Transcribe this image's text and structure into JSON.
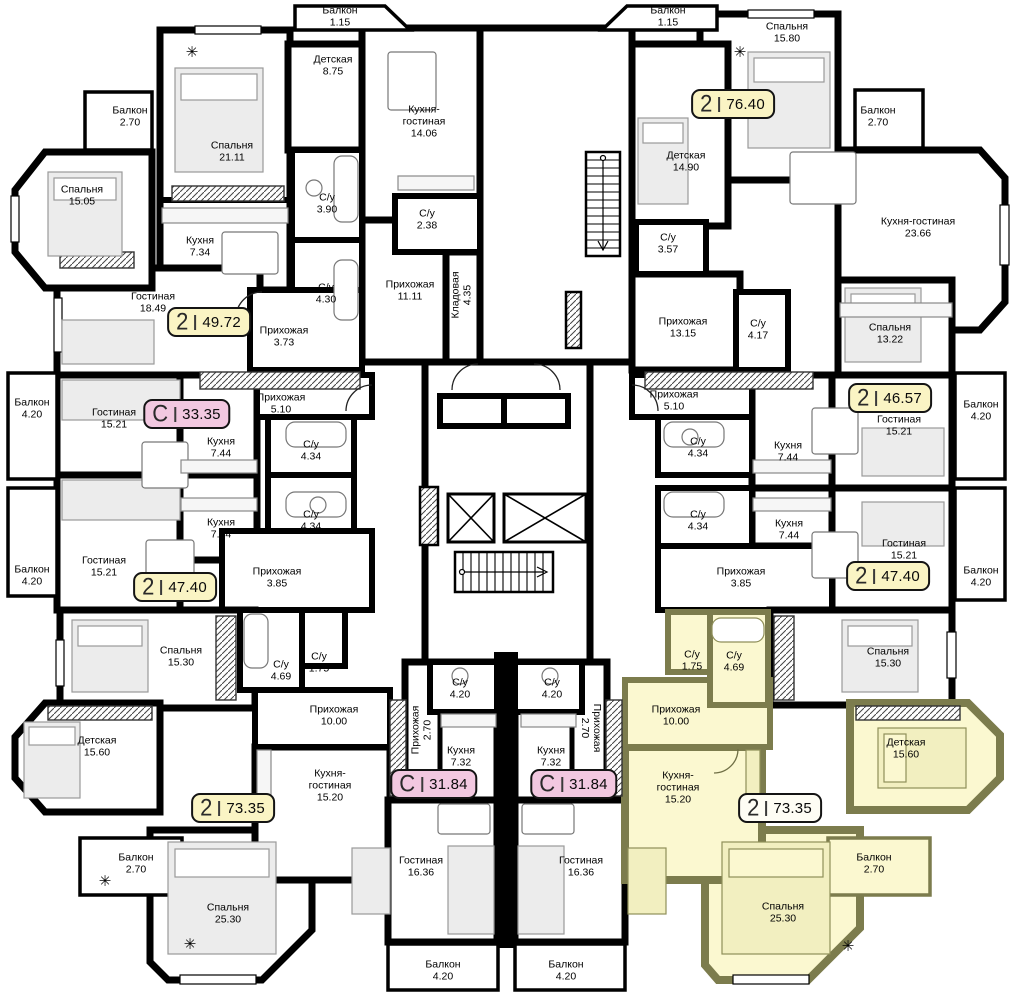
{
  "plan": {
    "badge_colors": {
      "yellow": "#FAF4C4",
      "pink": "#F2C8E0",
      "cream": "#FEFDF4"
    },
    "highlight": {
      "room_fill": "#FBF8D0",
      "wall_color": "#7C7C4D"
    },
    "walls_color": "#000000",
    "badges": [
      {
        "type": "2",
        "area": "49.72",
        "x": 209,
        "y": 322,
        "color": "yellow",
        "highlighted": false
      },
      {
        "type": "С",
        "area": "33.35",
        "x": 187,
        "y": 414,
        "color": "pink",
        "highlighted": false
      },
      {
        "type": "2",
        "area": "47.40",
        "x": 175,
        "y": 587,
        "color": "yellow",
        "highlighted": false
      },
      {
        "type": "2",
        "area": "73.35",
        "x": 233,
        "y": 808,
        "color": "yellow",
        "highlighted": false
      },
      {
        "type": "С",
        "area": "31.84",
        "x": 434,
        "y": 784,
        "color": "pink",
        "highlighted": false
      },
      {
        "type": "С",
        "area": "31.84",
        "x": 574,
        "y": 784,
        "color": "pink",
        "highlighted": false
      },
      {
        "type": "2",
        "area": "73.35",
        "x": 780,
        "y": 808,
        "color": "cream",
        "highlighted": true
      },
      {
        "type": "2",
        "area": "47.40",
        "x": 888,
        "y": 576,
        "color": "yellow",
        "highlighted": false
      },
      {
        "type": "2",
        "area": "46.57",
        "x": 890,
        "y": 398,
        "color": "yellow",
        "highlighted": false
      },
      {
        "type": "2",
        "area": "76.40",
        "x": 733,
        "y": 104,
        "color": "yellow",
        "highlighted": false
      }
    ],
    "rooms": [
      {
        "name": "Спальня",
        "area": "21.11",
        "x": 232,
        "y": 152
      },
      {
        "name": "Детская",
        "area": "8.75",
        "x": 333,
        "y": 66
      },
      {
        "name": "Балкон",
        "area": "2.70",
        "x": 130,
        "y": 117
      },
      {
        "name": "Спальня",
        "area": "15.05",
        "x": 82,
        "y": 196
      },
      {
        "name": "Кухня",
        "area": "7.34",
        "x": 200,
        "y": 247
      },
      {
        "name": "Гостиная",
        "area": "18.49",
        "x": 153,
        "y": 303
      },
      {
        "name": "С/у",
        "area": "3.90",
        "x": 327,
        "y": 204
      },
      {
        "name": "С/у",
        "area": "4.30",
        "x": 326,
        "y": 294
      },
      {
        "name": "Прихожая",
        "area": "3.73",
        "x": 284,
        "y": 337
      },
      {
        "name": "Балкон",
        "area": "1.15",
        "x": 340,
        "y": 17
      },
      {
        "name": "Кухня-гостиная",
        "area": "14.06",
        "x": 424,
        "y": 122,
        "w": 66
      },
      {
        "name": "С/у",
        "area": "2.38",
        "x": 427,
        "y": 220
      },
      {
        "name": "Прихожая",
        "area": "11.11",
        "x": 410,
        "y": 291
      },
      {
        "name": "Кладовая",
        "area": "4.35",
        "x": 462,
        "y": 295,
        "rot": -90
      },
      {
        "name": "Балкон",
        "area": "1.15",
        "x": 668,
        "y": 17
      },
      {
        "name": "Спальня",
        "area": "15.80",
        "x": 787,
        "y": 33
      },
      {
        "name": "Детская",
        "area": "14.90",
        "x": 686,
        "y": 162
      },
      {
        "name": "Балкон",
        "area": "2.70",
        "x": 878,
        "y": 117
      },
      {
        "name": "Кухня-гостиная",
        "area": "23.66",
        "x": 918,
        "y": 228,
        "w": 120
      },
      {
        "name": "С/у",
        "area": "3.57",
        "x": 668,
        "y": 244
      },
      {
        "name": "Прихожая",
        "area": "13.15",
        "x": 683,
        "y": 328
      },
      {
        "name": "С/у",
        "area": "4.17",
        "x": 758,
        "y": 330
      },
      {
        "name": "Спальня",
        "area": "13.22",
        "x": 890,
        "y": 334
      },
      {
        "name": "Гостиная",
        "area": "15.21",
        "x": 899,
        "y": 426
      },
      {
        "name": "Балкон",
        "area": "4.20",
        "x": 981,
        "y": 411,
        "w": 46
      },
      {
        "name": "Кухня",
        "area": "7.44",
        "x": 788,
        "y": 452
      },
      {
        "name": "С/у",
        "area": "4.34",
        "x": 698,
        "y": 448
      },
      {
        "name": "Прихожая",
        "area": "5.10",
        "x": 674,
        "y": 401
      },
      {
        "name": "Кухня",
        "area": "7.44",
        "x": 789,
        "y": 530
      },
      {
        "name": "С/у",
        "area": "4.34",
        "x": 698,
        "y": 521
      },
      {
        "name": "Гостиная",
        "area": "15.21",
        "x": 904,
        "y": 550
      },
      {
        "name": "Балкон",
        "area": "4.20",
        "x": 981,
        "y": 577,
        "w": 46
      },
      {
        "name": "Прихожая",
        "area": "3.85",
        "x": 741,
        "y": 578
      },
      {
        "name": "Спальня",
        "area": "15.30",
        "x": 888,
        "y": 658
      },
      {
        "name": "Гостиная",
        "area": "15.21",
        "x": 114,
        "y": 419
      },
      {
        "name": "Балкон",
        "area": "4.20",
        "x": 32,
        "y": 409,
        "w": 46
      },
      {
        "name": "Кухня",
        "area": "7.44",
        "x": 221,
        "y": 448
      },
      {
        "name": "С/у",
        "area": "4.34",
        "x": 311,
        "y": 451
      },
      {
        "name": "Прихожая",
        "area": "5.10",
        "x": 281,
        "y": 404
      },
      {
        "name": "С/у",
        "area": "4.34",
        "x": 311,
        "y": 521
      },
      {
        "name": "Кухня",
        "area": "7.44",
        "x": 221,
        "y": 529
      },
      {
        "name": "Гостиная",
        "area": "15.21",
        "x": 104,
        "y": 567
      },
      {
        "name": "Балкон",
        "area": "4.20",
        "x": 32,
        "y": 576,
        "w": 46
      },
      {
        "name": "Прихожая",
        "area": "3.85",
        "x": 277,
        "y": 578
      },
      {
        "name": "Спальня",
        "area": "15.30",
        "x": 181,
        "y": 657
      },
      {
        "name": "С/у",
        "area": "4.69",
        "x": 281,
        "y": 671
      },
      {
        "name": "С/у",
        "area": "1.75",
        "x": 319,
        "y": 663
      },
      {
        "name": "Прихожая",
        "area": "10.00",
        "x": 334,
        "y": 716
      },
      {
        "name": "Детская",
        "area": "15.60",
        "x": 97,
        "y": 747
      },
      {
        "name": "Кухня-гостиная",
        "area": "15.20",
        "x": 330,
        "y": 786,
        "w": 72
      },
      {
        "name": "Балкон",
        "area": "2.70",
        "x": 136,
        "y": 864
      },
      {
        "name": "Спальня",
        "area": "25.30",
        "x": 228,
        "y": 914
      },
      {
        "name": "С/у",
        "area": "4.20",
        "x": 460,
        "y": 689
      },
      {
        "name": "С/у",
        "area": "4.20",
        "x": 552,
        "y": 689
      },
      {
        "name": "Прихожая",
        "area": "2.70",
        "x": 422,
        "y": 730,
        "rot": -90
      },
      {
        "name": "Прихожая",
        "area": "2.70",
        "x": 590,
        "y": 728,
        "rot": 90
      },
      {
        "name": "Кухня",
        "area": "7.32",
        "x": 461,
        "y": 757
      },
      {
        "name": "Кухня",
        "area": "7.32",
        "x": 551,
        "y": 757
      },
      {
        "name": "Гостиная",
        "area": "16.36",
        "x": 421,
        "y": 867
      },
      {
        "name": "Гостиная",
        "area": "16.36",
        "x": 581,
        "y": 867
      },
      {
        "name": "Балкон",
        "area": "4.20",
        "x": 443,
        "y": 971
      },
      {
        "name": "Балкон",
        "area": "4.20",
        "x": 566,
        "y": 971
      },
      {
        "name": "Прихожая",
        "area": "10.00",
        "x": 676,
        "y": 716
      },
      {
        "name": "С/у",
        "area": "1.75",
        "x": 692,
        "y": 661
      },
      {
        "name": "С/у",
        "area": "4.69",
        "x": 734,
        "y": 662
      },
      {
        "name": "Кухня-гостиная",
        "area": "15.20",
        "x": 678,
        "y": 788,
        "w": 72
      },
      {
        "name": "Детская",
        "area": "15.60",
        "x": 906,
        "y": 749
      },
      {
        "name": "Балкон",
        "area": "2.70",
        "x": 874,
        "y": 864
      },
      {
        "name": "Спальня",
        "area": "25.30",
        "x": 783,
        "y": 913
      }
    ],
    "icons": [
      {
        "glyph": "✳",
        "x": 192,
        "y": 52
      },
      {
        "glyph": "✳",
        "x": 740,
        "y": 52
      },
      {
        "glyph": "✳",
        "x": 105,
        "y": 881
      },
      {
        "glyph": "✳",
        "x": 190,
        "y": 944
      },
      {
        "glyph": "✳",
        "x": 848,
        "y": 946
      }
    ]
  }
}
